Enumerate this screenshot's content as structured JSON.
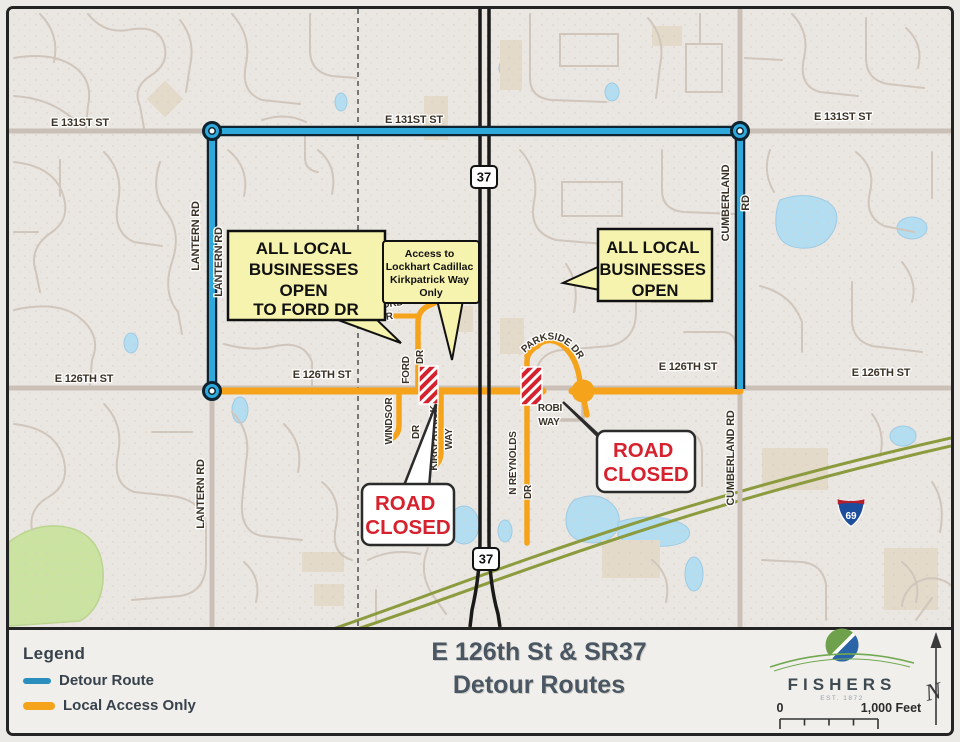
{
  "legend": {
    "title": "Legend",
    "items": [
      {
        "label": "Detour Route",
        "color": "#2B8FBE"
      },
      {
        "label": "Local Access Only",
        "color": "#F5A31A"
      }
    ]
  },
  "title_block": {
    "line1": "E 126th St & SR37",
    "line2": "Detour Routes"
  },
  "logo": {
    "name": "FISHERS",
    "est": "EST. 1872"
  },
  "north_label": "N",
  "scalebar": {
    "zero": "0",
    "max": "1,000 Feet"
  },
  "shields": {
    "sr37": "37",
    "i69": "69"
  },
  "road_labels": {
    "e131_left": "E 131ST ST",
    "e131_mid": "E 131ST ST",
    "e131_right": "E 131ST ST",
    "e126_left": "E 126TH ST",
    "e126_mid": "E 126TH ST",
    "e126_right_mid": "E 126TH ST",
    "e126_right": "E 126TH ST",
    "lantern_upper": "LANTERN RD",
    "lantern_mid": "LANTERN RD",
    "lantern_lower": "LANTERN RD",
    "cumberland_upper": "CUMBERLAND",
    "cumberland_upper_rd": "RD",
    "cumberland_lower": "CUMBERLAND RD",
    "ford_cir_1": "FORD",
    "ford_cir_2": "CIR",
    "ford_dr_1": "FORD",
    "ford_dr_2": "DR",
    "windsor_1": "WINDSOR",
    "windsor_2": "DR",
    "kirkpatrick_1": "KIRKPATRICK",
    "kirkpatrick_2": "WAY",
    "parkside": "PARKSIDE DR",
    "robi_1": "ROBI",
    "robi_2": "WAY",
    "reynolds_1": "N REYNOLDS",
    "reynolds_2": "DR"
  },
  "callouts": {
    "west": {
      "lines": [
        "ALL LOCAL",
        "BUSINESSES",
        "OPEN",
        "TO FORD DR"
      ]
    },
    "access": {
      "lines": [
        "Access to",
        "Lockhart Cadillac",
        "Kirkpatrick Way",
        "Only"
      ]
    },
    "east": {
      "lines": [
        "ALL LOCAL",
        "BUSINESSES",
        "OPEN"
      ]
    }
  },
  "road_closed": {
    "line1": "ROAD",
    "line2": "CLOSED"
  },
  "colors": {
    "detour": "#2FA8DC",
    "local_access": "#F5A31A",
    "closed_sign": "#D6222E"
  }
}
